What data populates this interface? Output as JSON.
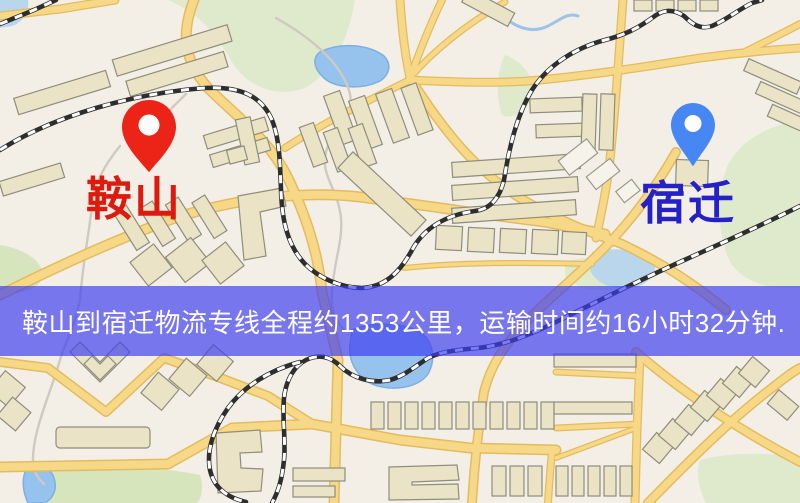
{
  "map": {
    "origin": {
      "name": "鞍山",
      "pin_color": "#ec2418",
      "label_color": "#dd1a0e"
    },
    "destination": {
      "name": "宿迁",
      "pin_color": "#4787f3",
      "label_color": "#2521c9"
    },
    "banner": {
      "text": "鞍山到宿迁物流专线全程约1353公里，运输时间约16小时32分钟.",
      "bg_color": "rgba(60,60,240,0.68)",
      "text_color": "#ffffff"
    }
  }
}
